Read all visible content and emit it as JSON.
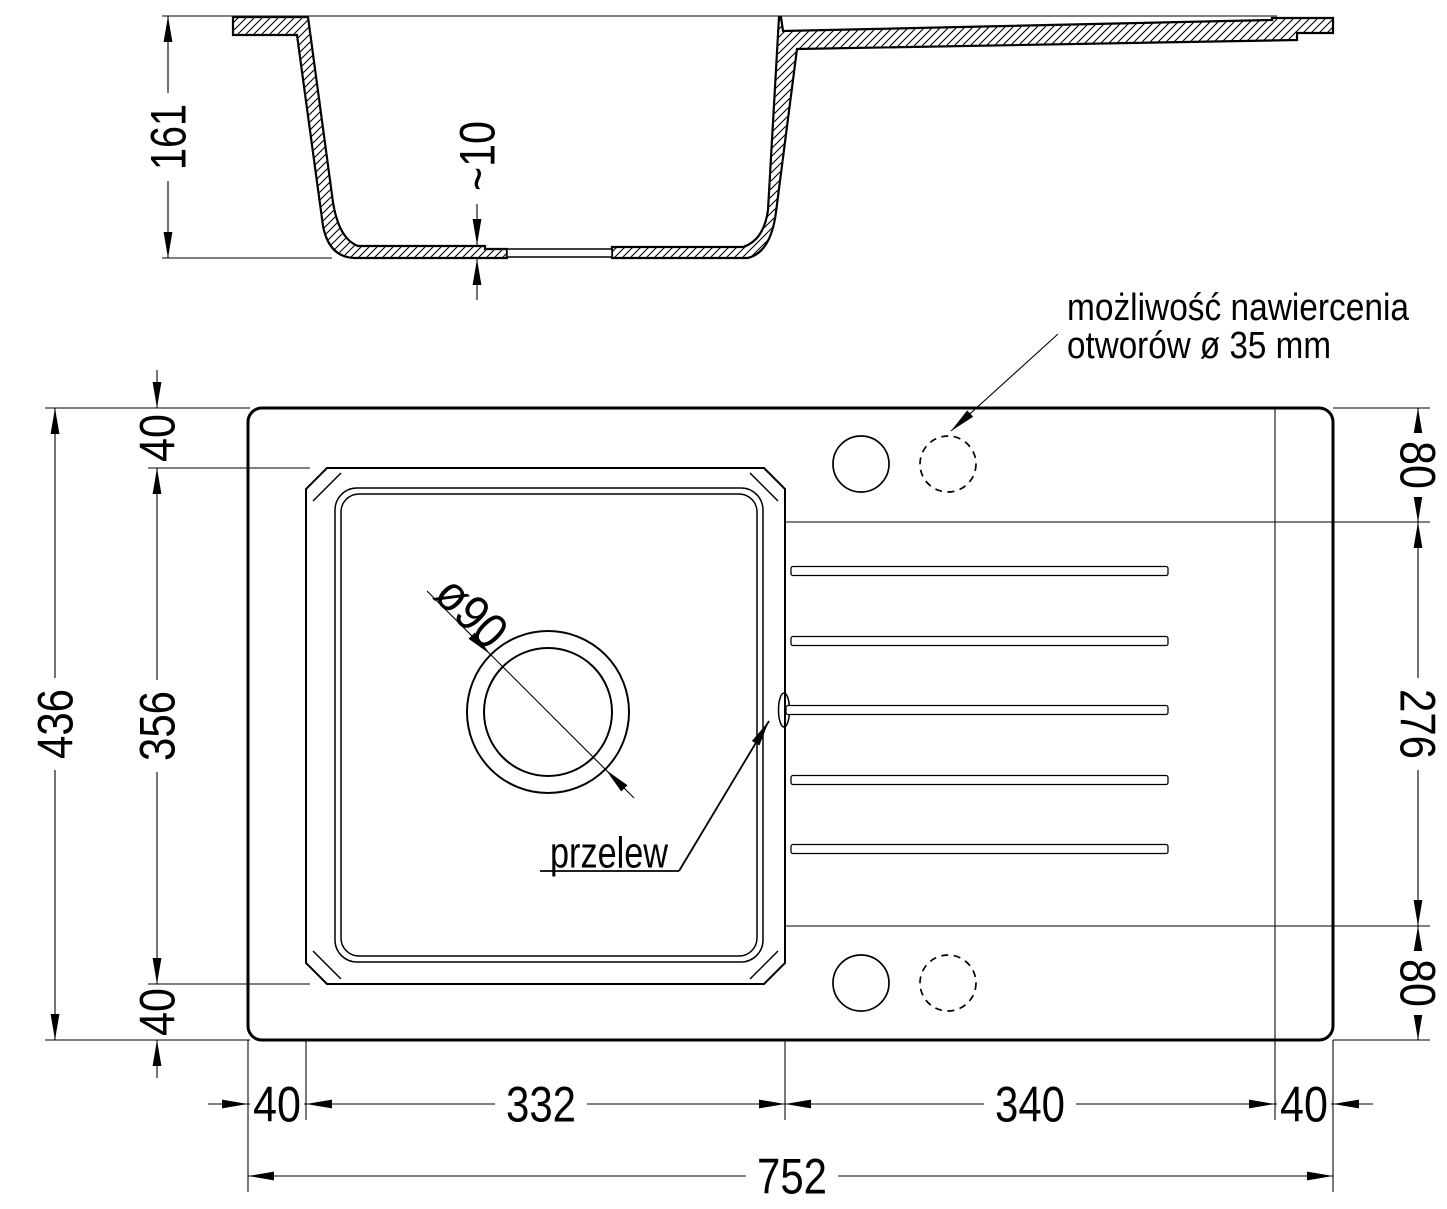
{
  "section": {
    "height_label": "161",
    "floor_thickness_label": "~10"
  },
  "plan": {
    "width_total": "752",
    "depth_total": "436",
    "bottom_segments": [
      "40",
      "332",
      "340",
      "40"
    ],
    "left_segments": [
      "40",
      "356",
      "40"
    ],
    "right_segments": [
      "80",
      "276",
      "80"
    ],
    "drain_label": "ø90",
    "overflow_label": "przelew",
    "drill_note_line1": "możliwość nawiercenia",
    "drill_note_line2": "otworów ø 35 mm"
  },
  "colors": {
    "line": "#000000",
    "background": "#ffffff"
  }
}
